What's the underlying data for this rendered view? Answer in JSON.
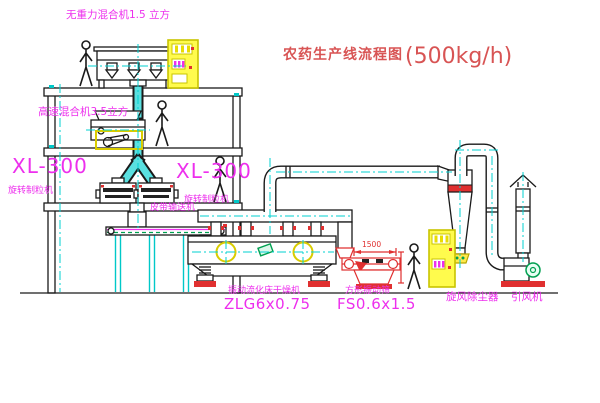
{
  "title": {
    "text": "农药生产线流程图",
    "capacity": "(500kg/h)"
  },
  "labels": {
    "gravity_mixer": "无重力混合机1.5 立方",
    "high_speed_mixer": "高速混合机3.5立方",
    "granulator_left_model": "XL-300",
    "granulator_left_name": "旋转制粒机",
    "granulator_right_model": "XL-300",
    "granulator_right_name": "旋转制粒机",
    "belt_conveyor": "皮带输送机",
    "dryer_name": "振动流化床干燥机",
    "dryer_model": "ZLG6x0.75",
    "screen_name": "方形振动筛",
    "screen_model": "FS0.6x1.5",
    "cyclone": "旋风除尘器",
    "fan": "引风机"
  },
  "dimensions": {
    "screen_length": "1500"
  },
  "colors": {
    "label_magenta": "#ed2fed",
    "title_red": "#d85454",
    "drawing_red": "#e03030",
    "cabinet_yellow": "#fffb4d",
    "centerline_cyan": "#00d2d2",
    "valve_green": "#00a050",
    "line_black": "#1a1a1a"
  }
}
